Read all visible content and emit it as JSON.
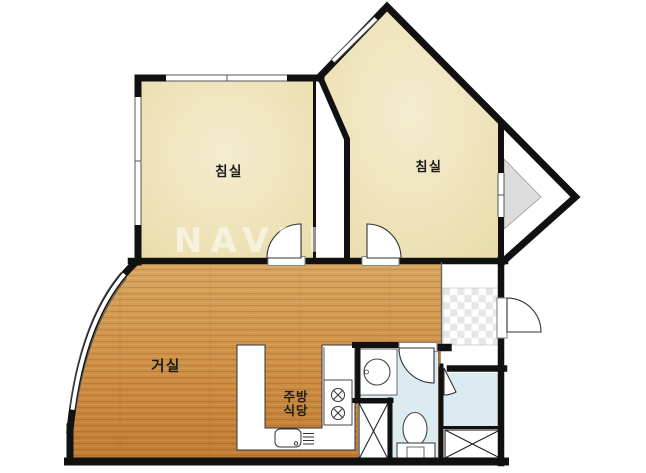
{
  "plan": {
    "type": "apartment-floor-plan",
    "watermark": "NAVER",
    "rooms": [
      {
        "id": "bedroom-left",
        "label": "침실"
      },
      {
        "id": "bedroom-right",
        "label": "침실"
      },
      {
        "id": "living-room",
        "label": "거실"
      },
      {
        "id": "kitchen-dining",
        "label_line1": "주방",
        "label_line2": "식당"
      }
    ],
    "features": [
      "entry-hall-checker-tile",
      "bathroom",
      "utility-room",
      "bay-window",
      "kitchen-counter",
      "stove-2-burner",
      "sink",
      "toilet",
      "washbasin",
      "washer-closet-x",
      "shoe-closet-x",
      "curved-balcony-window"
    ]
  },
  "colors": {
    "wall": "#111111",
    "beige_center": "#f4ecd0",
    "beige_edge": "#e9dba6",
    "wood_top": "#d8a660",
    "wood_mid": "#cf9248",
    "wood_bottom": "#bf7b32",
    "bath_blue": "#dcebf2",
    "checker_gray": "#e6e6e4",
    "bay_gray": "#dcdcdc",
    "fixture_line": "#444444",
    "door_line": "#333333",
    "window_line": "#555555",
    "sill_line": "#8a8a8a"
  }
}
